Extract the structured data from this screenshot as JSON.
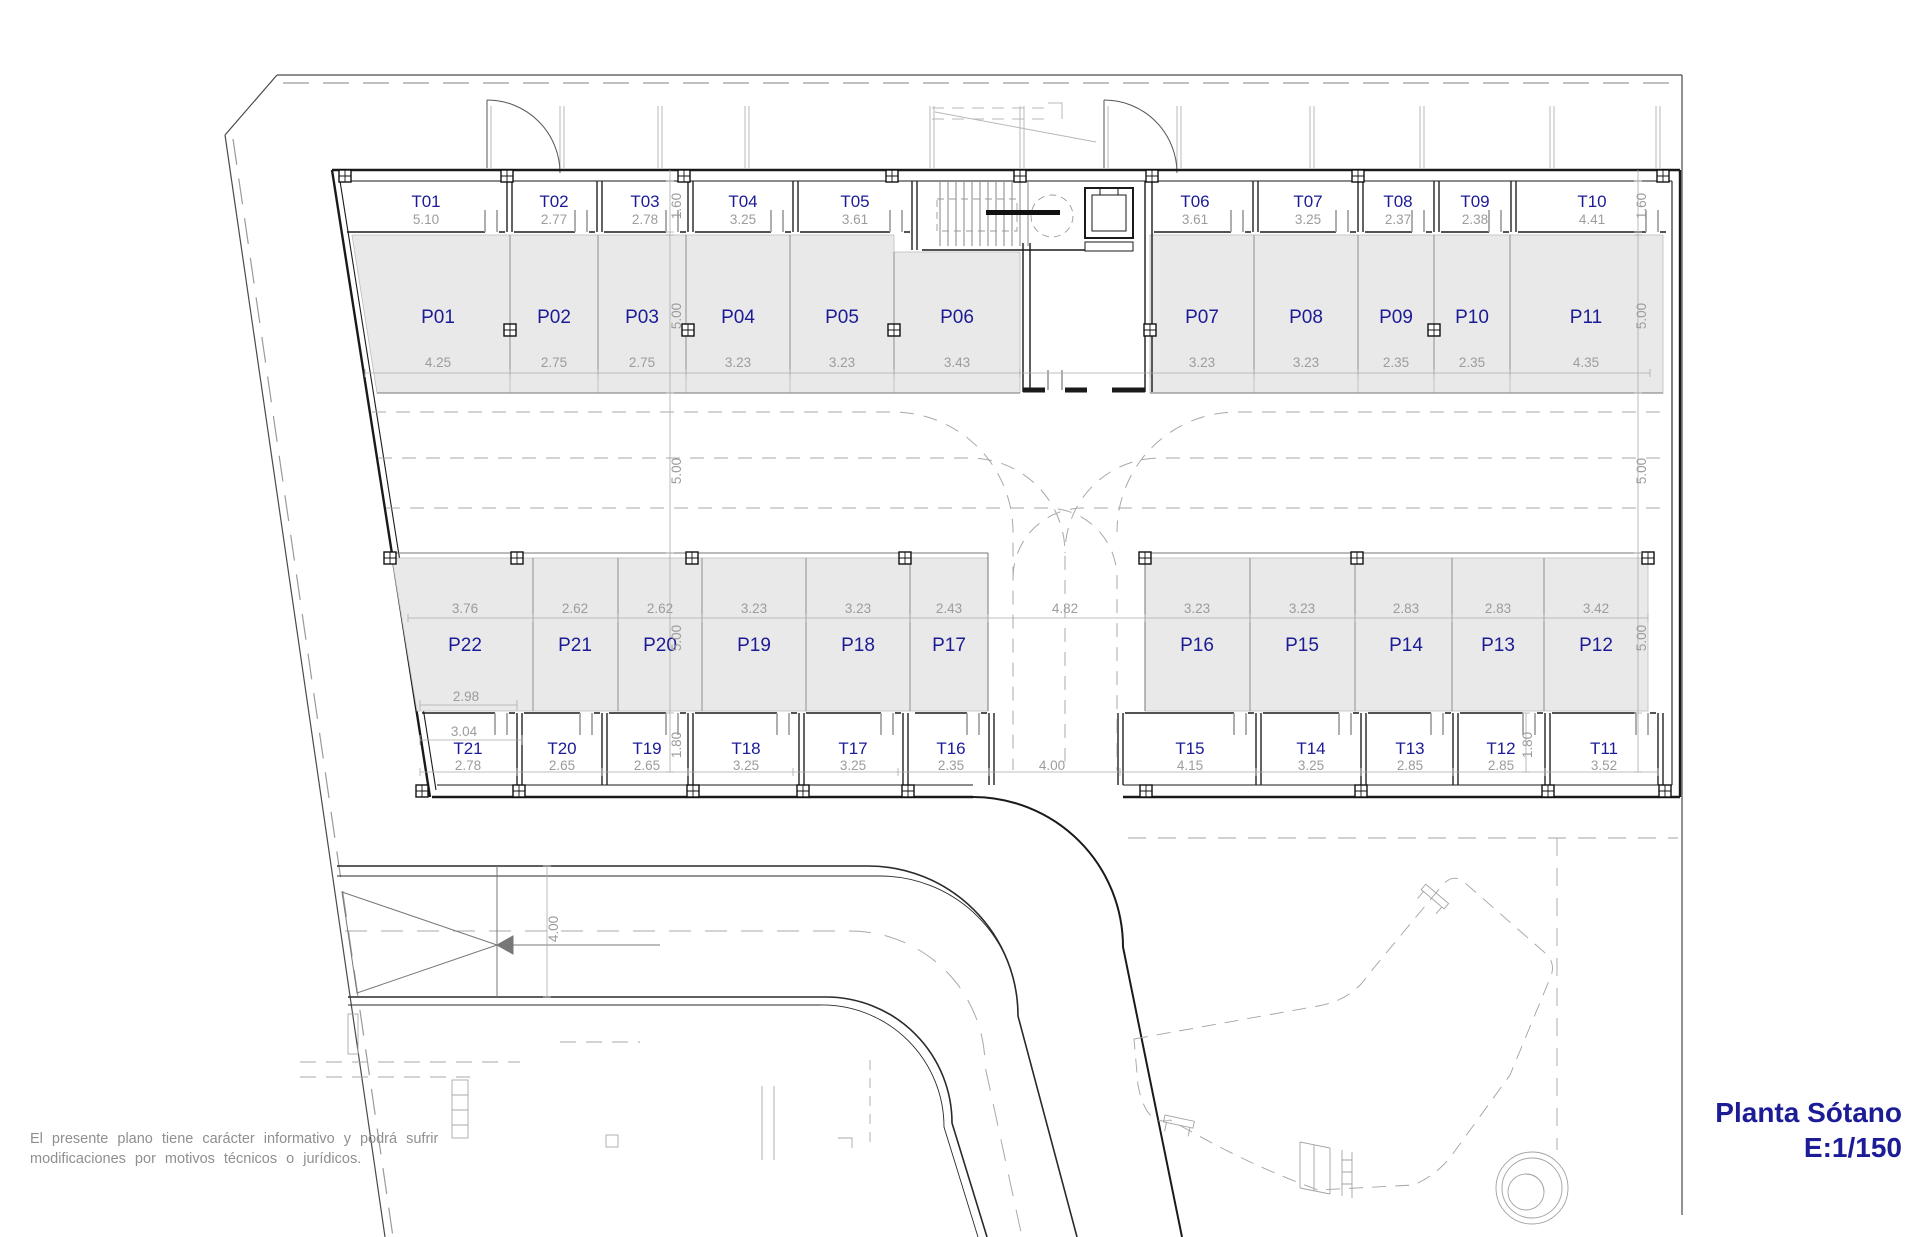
{
  "meta": {
    "plan_title": "Planta Sótano",
    "plan_scale": "E:1/150"
  },
  "disclaimer": {
    "line1": "El presente plano tiene carácter informativo y podrá sufrir",
    "line2": "modificaciones por motivos técnicos o jurídicos."
  },
  "storage_top": [
    {
      "id": "T01",
      "dim": "5.10"
    },
    {
      "id": "T02",
      "dim": "2.77"
    },
    {
      "id": "T03",
      "dim": "2.78"
    },
    {
      "id": "T04",
      "dim": "3.25"
    },
    {
      "id": "T05",
      "dim": "3.61"
    },
    {
      "id": "T06",
      "dim": "3.61"
    },
    {
      "id": "T07",
      "dim": "3.25"
    },
    {
      "id": "T08",
      "dim": "2.37"
    },
    {
      "id": "T09",
      "dim": "2.38"
    },
    {
      "id": "T10",
      "dim": "4.41"
    }
  ],
  "parking_top": [
    {
      "id": "P01",
      "dim": "4.25"
    },
    {
      "id": "P02",
      "dim": "2.75"
    },
    {
      "id": "P03",
      "dim": "2.75"
    },
    {
      "id": "P04",
      "dim": "3.23"
    },
    {
      "id": "P05",
      "dim": "3.23"
    },
    {
      "id": "P06",
      "dim": "3.43"
    },
    {
      "id": "P07",
      "dim": "3.23"
    },
    {
      "id": "P08",
      "dim": "3.23"
    },
    {
      "id": "P09",
      "dim": "2.35"
    },
    {
      "id": "P10",
      "dim": "2.35"
    },
    {
      "id": "P11",
      "dim": "4.35"
    }
  ],
  "parking_mid": [
    {
      "id": "P22",
      "dim": "3.76"
    },
    {
      "id": "P21",
      "dim": "2.62"
    },
    {
      "id": "P20",
      "dim": "2.62"
    },
    {
      "id": "P19",
      "dim": "3.23"
    },
    {
      "id": "P18",
      "dim": "3.23"
    },
    {
      "id": "P17",
      "dim": "2.43"
    },
    {
      "id": "P16",
      "dim": "3.23"
    },
    {
      "id": "P15",
      "dim": "3.23"
    },
    {
      "id": "P14",
      "dim": "2.83"
    },
    {
      "id": "P13",
      "dim": "2.83"
    },
    {
      "id": "P12",
      "dim": "3.42"
    }
  ],
  "storage_bottom": [
    {
      "id": "T21",
      "dim": "2.78"
    },
    {
      "id": "T20",
      "dim": "2.65"
    },
    {
      "id": "T19",
      "dim": "2.65"
    },
    {
      "id": "T18",
      "dim": "3.25"
    },
    {
      "id": "T17",
      "dim": "3.25"
    },
    {
      "id": "T16",
      "dim": "2.35"
    },
    {
      "id": "T15",
      "dim": "4.15"
    },
    {
      "id": "T14",
      "dim": "3.25"
    },
    {
      "id": "T13",
      "dim": "2.85"
    },
    {
      "id": "T12",
      "dim": "2.85"
    },
    {
      "id": "T11",
      "dim": "3.52"
    }
  ],
  "dims": {
    "t_top": "1.60",
    "depth": "5.00",
    "t_bottom": "1.80",
    "aisle": "4.82",
    "lane": "4.00",
    "ramp": "4.00",
    "left_upper": "2.98",
    "left_lower": "3.04"
  },
  "colors": {
    "label": "#1b1b96",
    "dim_text": "#9c9c9c",
    "stall_fill": "#e9e9e9",
    "wall": "#1a1a1a"
  }
}
